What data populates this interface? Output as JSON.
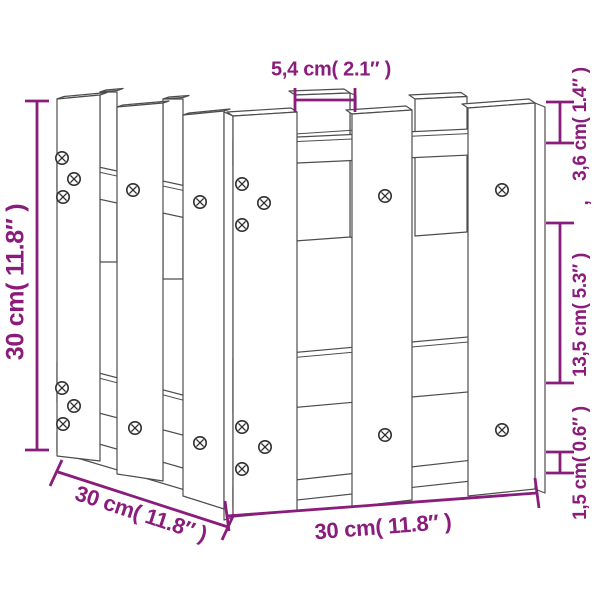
{
  "accent_color": "#8A1C7C",
  "line_color": "#4d4d4d",
  "diagram": {
    "subject": "fence-style-planter-line-drawing",
    "view": "three-quarter perspective with dimension callouts"
  },
  "dimensions": {
    "top_width": {
      "label": "5,4 cm( 2.1″ )",
      "value_cm": 5.4,
      "value_in": 2.1
    },
    "left_height": {
      "label": "30 cm( 11.8″ )",
      "value_cm": 30,
      "value_in": 11.8
    },
    "right_top": {
      "label": "3,6 cm( 1.4″ )",
      "value_cm": 3.6,
      "value_in": 1.4
    },
    "right_separator": ",",
    "right_middle": {
      "label": "13,5 cm( 5.3″ )",
      "value_cm": 13.5,
      "value_in": 5.3
    },
    "right_bottom": {
      "label": "1,5 cm( 0.6″ )",
      "value_cm": 1.5,
      "value_in": 0.6
    },
    "bottom_depth": {
      "label": "30 cm( 11.8″ )",
      "value_cm": 30,
      "value_in": 11.8
    },
    "bottom_width": {
      "label": "30 cm( 11.8″ )",
      "value_cm": 30,
      "value_in": 11.8
    }
  }
}
